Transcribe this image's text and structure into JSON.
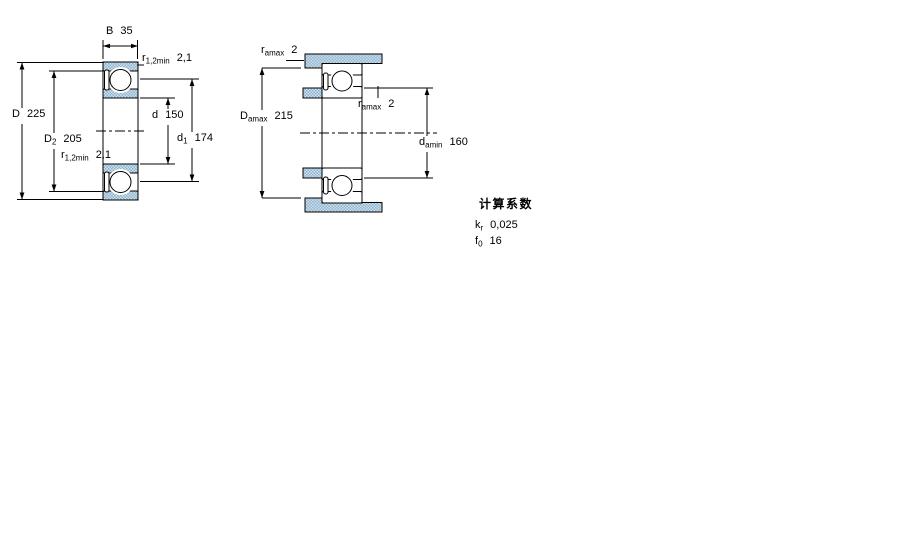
{
  "figure_left": {
    "name": "bearing cross-section with shield",
    "b": {
      "sym": "B",
      "value": "35"
    },
    "r_top": {
      "sym": "r",
      "sub": "1,2min",
      "value": "2,1"
    },
    "D": {
      "sym": "D",
      "value": "225"
    },
    "D2": {
      "sym": "D",
      "sub": "2",
      "value": "205"
    },
    "d": {
      "sym": "d",
      "value": "150"
    },
    "d1": {
      "sym": "d",
      "sub": "1",
      "value": "174"
    },
    "r_bottom": {
      "sym": "r",
      "sub": "1,2min",
      "value": "2,1"
    }
  },
  "figure_right": {
    "name": "abutment and fillet dimensions",
    "ra_top": {
      "sym": "r",
      "sub": "amax",
      "value": "2"
    },
    "Da": {
      "sym": "D",
      "sub": "amax",
      "value": "215"
    },
    "ra_mid": {
      "sym": "r",
      "sub": "amax",
      "value": "2"
    },
    "da": {
      "sym": "d",
      "sub": "amin",
      "value": "160"
    }
  },
  "calculation_factors": {
    "heading": "计算系数",
    "kr": {
      "sym": "k",
      "sub": "r",
      "value": "0,025"
    },
    "f0": {
      "sym": "f",
      "sub": "0",
      "value": "16"
    }
  },
  "colors": {
    "hatch_light": "#cde0ec",
    "hatch_dark": "#8fb4cc",
    "line": "#000000",
    "background": "#ffffff"
  }
}
